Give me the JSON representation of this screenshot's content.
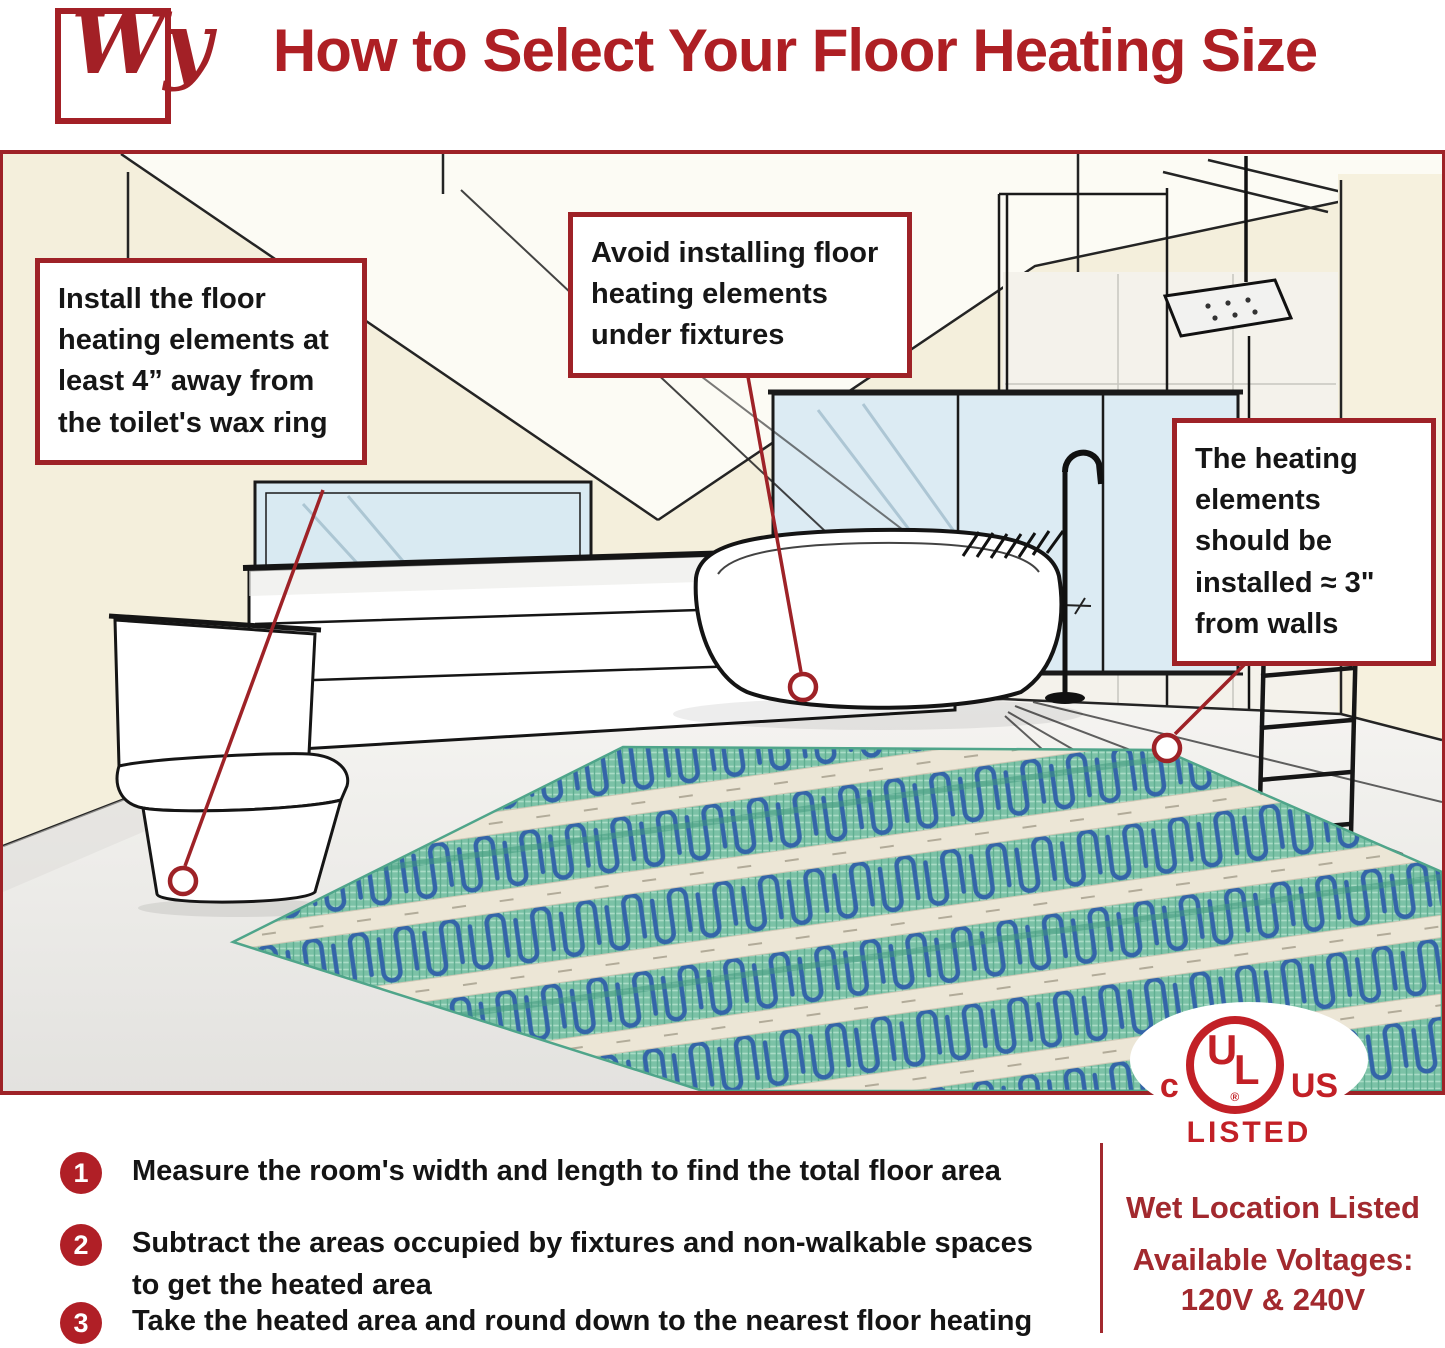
{
  "header": {
    "logo_text": "Wy",
    "title": "How to Select Your Floor Heating Size"
  },
  "callouts": {
    "toilet": "Install the floor heating elements at least 4” away from the toilet's wax ring",
    "fixtures": "Avoid installing floor heating elements under fixtures",
    "walls": "The heating elements should be installed ≈ 3\" from walls"
  },
  "steps": [
    {
      "number": "1",
      "text": "Measure the room's width and length to find the total floor area"
    },
    {
      "number": "2",
      "text": "Subtract the areas occupied by fixtures and non-walkable spaces to get the heated area"
    },
    {
      "number": "3",
      "text": "Take the heated area and round down to the nearest floor heating size"
    }
  ],
  "certification": {
    "ul_left": "c",
    "ul_letter_u": "U",
    "ul_letter_l": "L",
    "ul_reg": "®",
    "ul_right": "US",
    "ul_listed": "LISTED",
    "wet_location": "Wet Location Listed",
    "voltages_label": "Available Voltages:",
    "voltages_value": "120V & 240V"
  },
  "colors": {
    "accent_red": "#A32026",
    "border_red": "#9E2227",
    "ul_red": "#C22026",
    "step_circle_red": "#B01F26",
    "mat_green": "#7CC2A7",
    "cable_blue": "#3465A8",
    "window_blue": "#D9EAF2",
    "wall_cream": "#F4EFDC"
  }
}
